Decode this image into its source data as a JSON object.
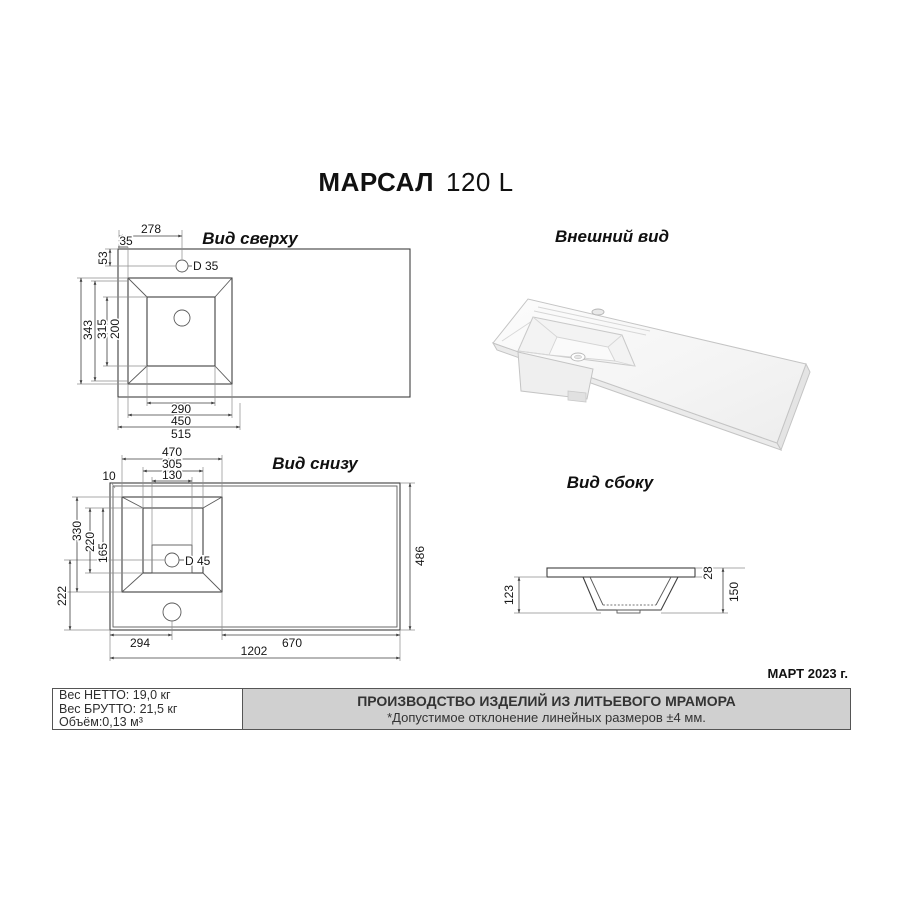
{
  "page": {
    "title_model": "МАРСАЛ",
    "title_size": "120 L",
    "date_note": "МАРТ 2023 г."
  },
  "views": {
    "top": {
      "title": "Вид сверху",
      "dims": {
        "s278": "278",
        "s35": "35",
        "s53": "53",
        "hole": "D 35",
        "d343": "343",
        "d315": "315",
        "d200": "200",
        "w290": "290",
        "w450": "450",
        "w515": "515"
      }
    },
    "external": {
      "title": "Внешний вид"
    },
    "bottom": {
      "title": "Вид снизу",
      "dims": {
        "w470": "470",
        "w305": "305",
        "w130": "130",
        "i10": "10",
        "d330": "330",
        "d220": "220",
        "d165": "165",
        "d222": "222",
        "hole": "D 45",
        "d486": "486",
        "w294": "294",
        "w670": "670",
        "w1202": "1202"
      }
    },
    "side": {
      "title": "Вид сбоку",
      "dims": {
        "h123": "123",
        "t28": "28",
        "h150": "150"
      }
    }
  },
  "footer": {
    "net_weight": "Вес НЕТТО: 19,0 кг",
    "gross_weight": "Вес БРУТТО: 21,5 кг",
    "volume": "Объём:0,13 м³",
    "production_line1": "ПРОИЗВОДСТВО ИЗДЕЛИЙ ИЗ ЛИТЬЕВОГО МРАМОРА",
    "production_line2": "*Допустимое отклонение линейных размеров ±4 мм."
  },
  "colors": {
    "line": "#3f3f3f",
    "footer_bg": "#d0d0d0"
  }
}
